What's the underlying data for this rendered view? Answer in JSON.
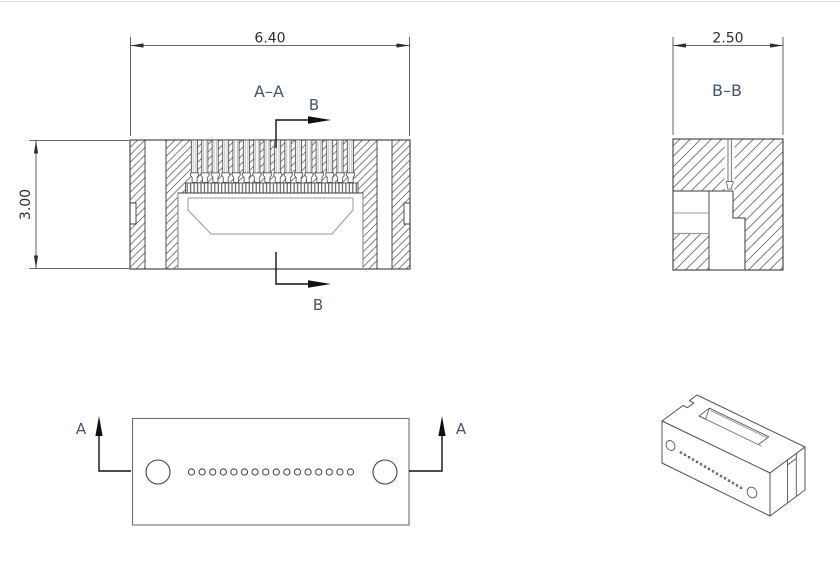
{
  "drawing": {
    "background": "#ffffff",
    "markers": {
      "a": "A",
      "b": "B"
    },
    "views": {
      "section_aa": {
        "label": "A–A",
        "width_dim": "6.40",
        "height_dim": "3.00",
        "pin_channel_count": 16
      },
      "section_bb": {
        "label": "B–B",
        "width_dim": "2.50"
      },
      "plan": {
        "marker": "A",
        "small_hole_count": 16,
        "mounting_hole_count": 2
      },
      "isometric": {
        "dot_count": 16,
        "hole_count": 2
      }
    },
    "colors": {
      "line": "#3a3a3a",
      "secondary_line": "#9a9a9a",
      "hatch": "#6f6f6f",
      "label_text": "#46536e",
      "dim_text": "#2d2d2d"
    }
  }
}
